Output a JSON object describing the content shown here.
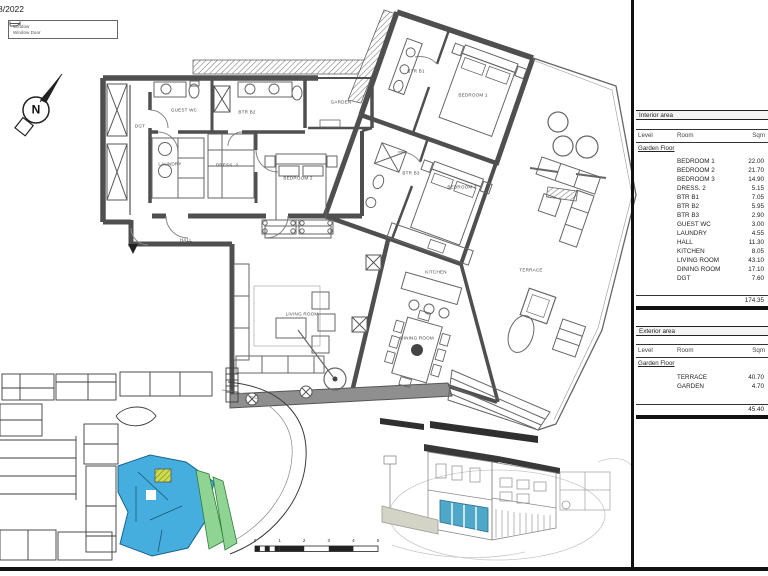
{
  "header": {
    "date_label": "8/2022"
  },
  "legend": {
    "items": [
      {
        "id": "window",
        "label": "Window"
      },
      {
        "id": "window-door",
        "label": "Window Door"
      }
    ]
  },
  "compass": {
    "label": "N"
  },
  "floor_plan": {
    "room_labels": [
      {
        "id": "dgt",
        "label": "DGT",
        "x": 140,
        "y": 126
      },
      {
        "id": "guest-wc",
        "label": "GUEST WC",
        "x": 184,
        "y": 110
      },
      {
        "id": "btr-b2",
        "label": "BTR B2",
        "x": 247,
        "y": 112
      },
      {
        "id": "garden",
        "label": "GARDEN",
        "x": 341,
        "y": 102
      },
      {
        "id": "laundry",
        "label": "LAUNDRY",
        "x": 170,
        "y": 164
      },
      {
        "id": "dress-2",
        "label": "DRESS. 2",
        "x": 227,
        "y": 165
      },
      {
        "id": "bedroom-2",
        "label": "BEDROOM 2",
        "x": 298,
        "y": 178
      },
      {
        "id": "hall",
        "label": "HALL",
        "x": 186,
        "y": 240
      },
      {
        "id": "btr-b1",
        "label": "BTR B1",
        "x": 416,
        "y": 71
      },
      {
        "id": "bedroom-1",
        "label": "BEDROOM 1",
        "x": 473,
        "y": 95
      },
      {
        "id": "btr-b3",
        "label": "BTR B3",
        "x": 411,
        "y": 173
      },
      {
        "id": "bedroom-3",
        "label": "BEDROOM 3",
        "x": 462,
        "y": 187
      },
      {
        "id": "kitchen",
        "label": "KITCHEN",
        "x": 436,
        "y": 272
      },
      {
        "id": "living-room",
        "label": "LIVING ROOM",
        "x": 302,
        "y": 314
      },
      {
        "id": "dining-room",
        "label": "DINING ROOM",
        "x": 417,
        "y": 338
      },
      {
        "id": "terrace",
        "label": "TERRACE",
        "x": 531,
        "y": 270
      }
    ]
  },
  "scale_bar": {
    "ticks": [
      "0",
      "1",
      "2",
      "3",
      "4",
      "5"
    ]
  },
  "area_tables": {
    "interior": {
      "title": "Interior area",
      "columns": {
        "level": "Level",
        "room": "Room",
        "sqm": "Sqm"
      },
      "level_label": "Garden Floor",
      "rows": [
        {
          "room": "BEDROOM 1",
          "sqm": "22.00"
        },
        {
          "room": "BEDROOM 2",
          "sqm": "21.70"
        },
        {
          "room": "BEDROOM 3",
          "sqm": "14.90"
        },
        {
          "room": "DRESS. 2",
          "sqm": "5.15"
        },
        {
          "room": "BTR B1",
          "sqm": "7.05"
        },
        {
          "room": "BTR B2",
          "sqm": "5.95"
        },
        {
          "room": "BTR B3",
          "sqm": "2.90"
        },
        {
          "room": "GUEST WC",
          "sqm": "3.00"
        },
        {
          "room": "LAUNDRY",
          "sqm": "4.55"
        },
        {
          "room": "HALL",
          "sqm": "11.30"
        },
        {
          "room": "KITCHEN",
          "sqm": "8.05"
        },
        {
          "room": "LIVING ROOM",
          "sqm": "43.10"
        },
        {
          "room": "DINING ROOM",
          "sqm": "17.10"
        },
        {
          "room": "DGT",
          "sqm": "7.60"
        }
      ],
      "total": "174.35"
    },
    "exterior": {
      "title": "Exterior area",
      "columns": {
        "level": "Level",
        "room": "Room",
        "sqm": "Sqm"
      },
      "level_label": "Garden Floor",
      "rows": [
        {
          "room": "TERRACE",
          "sqm": "40.70"
        },
        {
          "room": "GARDEN",
          "sqm": "4.70"
        }
      ],
      "total": "45.40"
    }
  },
  "colors": {
    "unit_highlight_blue": "#45AEDE",
    "exterior_highlight_green": "#8FD492",
    "hatch_yellow_green": "#CBDB4E",
    "sketch_blue": "#4FA8C8",
    "wall_gray": "#4F4F4F"
  }
}
